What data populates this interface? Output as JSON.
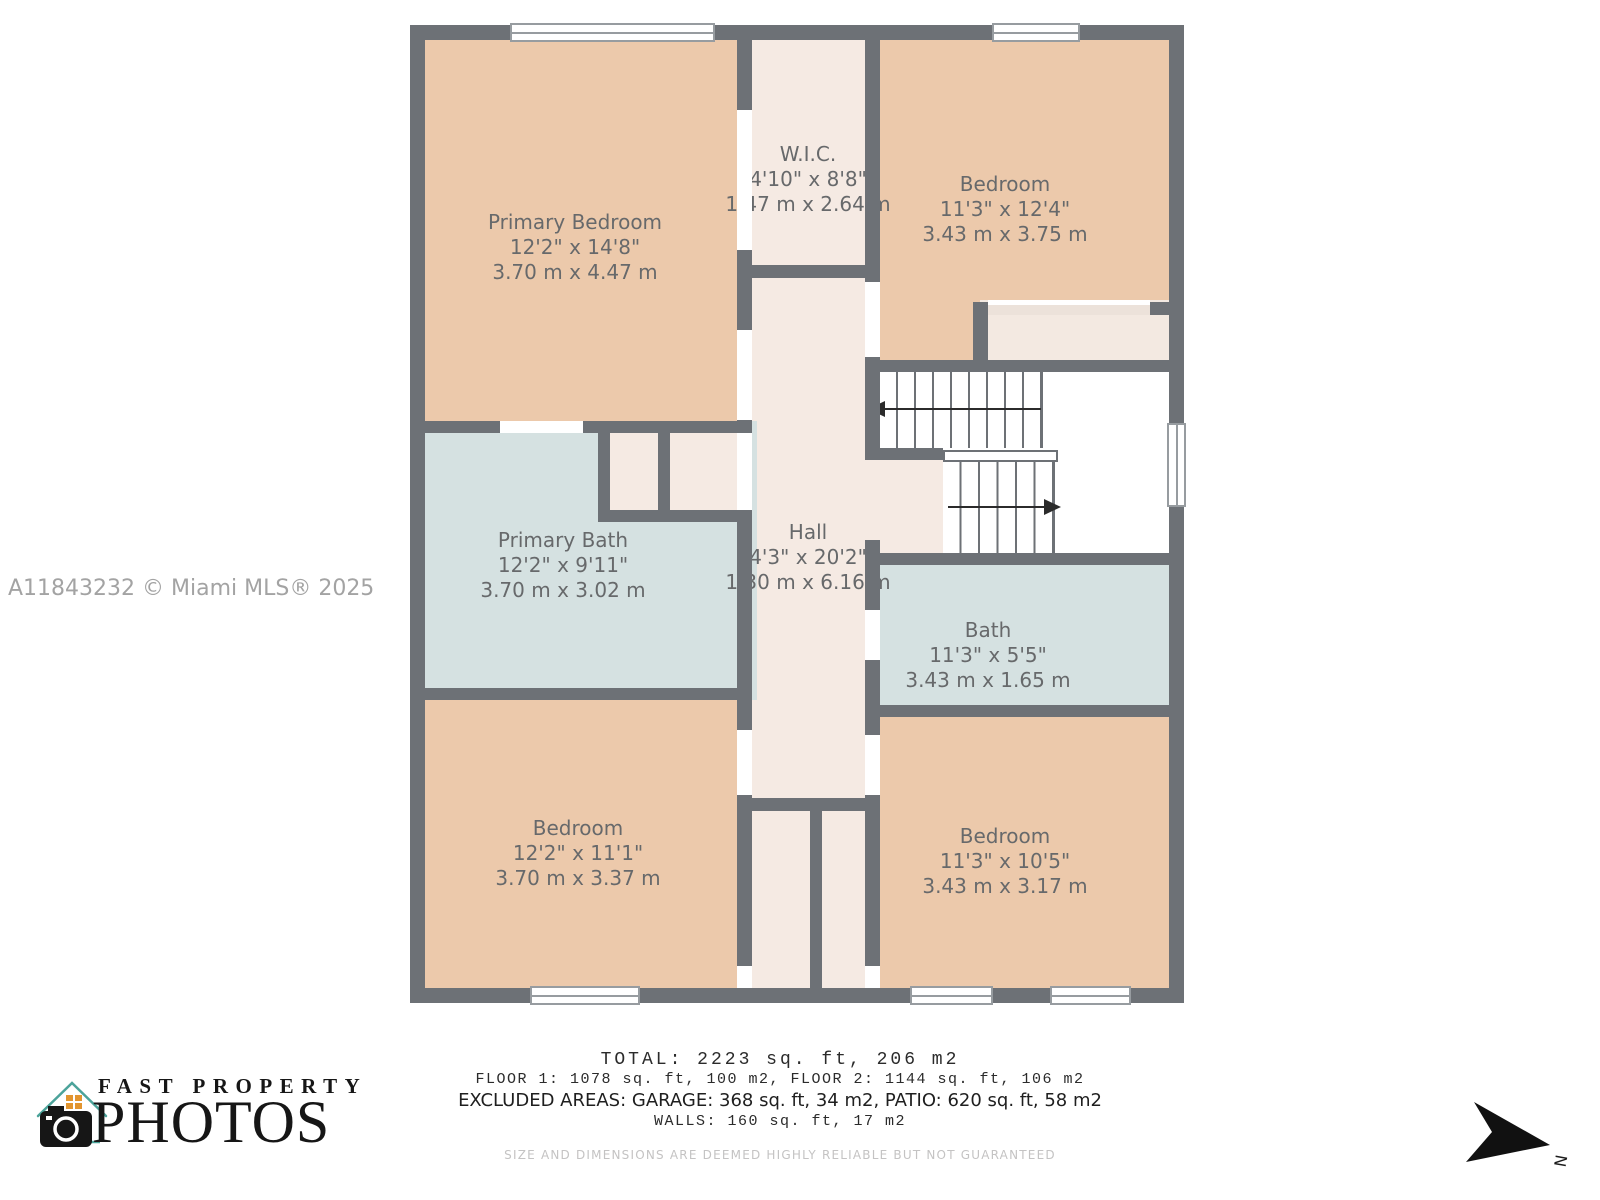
{
  "watermark": "A11843232 © Miami MLS® 2025",
  "rooms": {
    "primary_bedroom": {
      "name": "Primary Bedroom",
      "imperial": "12'2\" x 14'8\"",
      "metric": "3.70 m x 4.47 m"
    },
    "wic": {
      "name": "W.I.C.",
      "imperial": "4'10\" x 8'8\"",
      "metric": "1.47 m x 2.64 m"
    },
    "bedroom_top_right": {
      "name": "Bedroom",
      "imperial": "11'3\" x 12'4\"",
      "metric": "3.43 m x 3.75 m"
    },
    "primary_bath": {
      "name": "Primary Bath",
      "imperial": "12'2\" x 9'11\"",
      "metric": "3.70 m x 3.02 m"
    },
    "hall": {
      "name": "Hall",
      "imperial": "4'3\" x 20'2\"",
      "metric": "1.30 m x 6.16 m"
    },
    "bath": {
      "name": "Bath",
      "imperial": "11'3\" x 5'5\"",
      "metric": "3.43 m x 1.65 m"
    },
    "bedroom_bottom_left": {
      "name": "Bedroom",
      "imperial": "12'2\" x 11'1\"",
      "metric": "3.70 m x 3.37 m"
    },
    "bedroom_bottom_right": {
      "name": "Bedroom",
      "imperial": "11'3\" x 10'5\"",
      "metric": "3.43 m x 3.17 m"
    }
  },
  "summary": {
    "total": "TOTAL: 2223 sq. ft, 206 m2",
    "floors": "FLOOR 1: 1078 sq. ft, 100 m2, FLOOR 2: 1144 sq. ft, 106 m2",
    "excluded": "EXCLUDED AREAS: GARAGE: 368 sq. ft, 34 m2, PATIO: 620 sq. ft, 58 m2",
    "walls": "WALLS: 160 sq. ft, 17 m2",
    "disclaimer": "SIZE AND DIMENSIONS ARE DEEMED HIGHLY RELIABLE BUT NOT GUARANTEED"
  },
  "logo": {
    "line1": "FAST PROPERTY",
    "line2": "PHOTOS"
  },
  "compass": {
    "label": "N"
  },
  "colors": {
    "wall": "#6d7176",
    "bedroom_fill": "#ecc9ab",
    "bath_fill": "#d5e1e1",
    "hall_fill": "#f5eae3",
    "label_text": "#67696b",
    "logo_teal": "#4ba39a",
    "logo_orange": "#e2952f"
  }
}
